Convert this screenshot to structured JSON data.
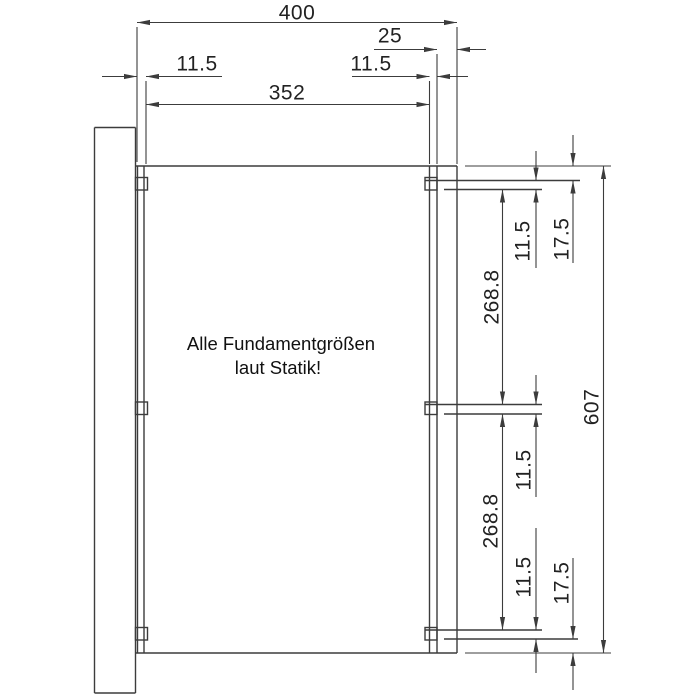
{
  "colors": {
    "line": "#3c3c3c",
    "text": "#222222",
    "background": "#ffffff"
  },
  "note": {
    "line1": "Alle Fundamentgrößen",
    "line2": "laut Statik!"
  },
  "dims": {
    "overall_width": "400",
    "right_post_width": "25",
    "left_member_width": "11.5",
    "right_member_width": "11.5",
    "clear_width": "352",
    "top_offset": "17.5",
    "top_rail": "11.5",
    "upper_bay": "268.8",
    "overall_height": "607",
    "mid_rail": "11.5",
    "lower_bay": "268.8",
    "bottom_rail": "11.5",
    "bottom_offset": "17.5"
  }
}
